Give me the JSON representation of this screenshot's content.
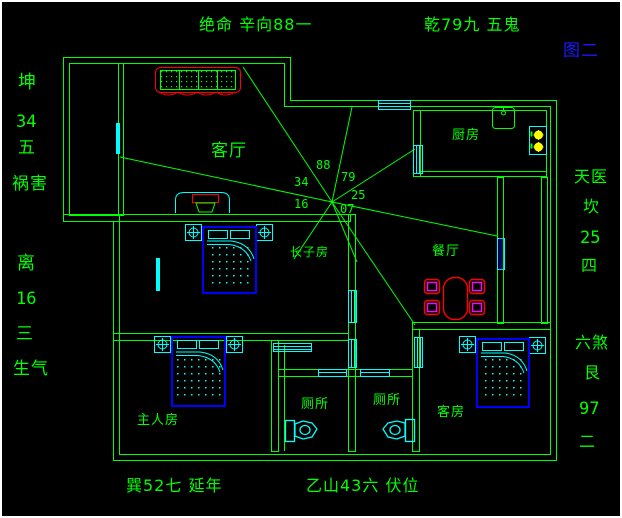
{
  "figure": {
    "label": "图二"
  },
  "annotations": {
    "top_left": "绝命 辛向88一",
    "top_right": "乾79九 五鬼",
    "left": [
      "坤",
      "34",
      "五",
      "祸害",
      "离",
      "16",
      "三",
      "生气"
    ],
    "right": [
      "天医",
      "坎",
      "25",
      "四",
      "六煞",
      "艮",
      "97",
      "二"
    ],
    "bottom": [
      "巽52七 延年",
      "乙山43六 伏位"
    ]
  },
  "rooms": {
    "living": "客厅",
    "kitchen": "厨房",
    "dining": "餐厅",
    "eldest_son": "长子房",
    "master": "主人房",
    "toilet_left": "厕所",
    "toilet_right": "厕所",
    "guest": "客房"
  },
  "center_numbers": [
    "88",
    "79",
    "34",
    "25",
    "16",
    "07"
  ],
  "colors": {
    "wall": "#00ff00",
    "fixture": "#00ffff",
    "furniture_accent": "#ff0000",
    "bed_frame": "#0000ff",
    "chair_inner": "#ff00ff",
    "burner": "#ffff00",
    "figure_label": "#1a1aff",
    "background": "#000000"
  }
}
